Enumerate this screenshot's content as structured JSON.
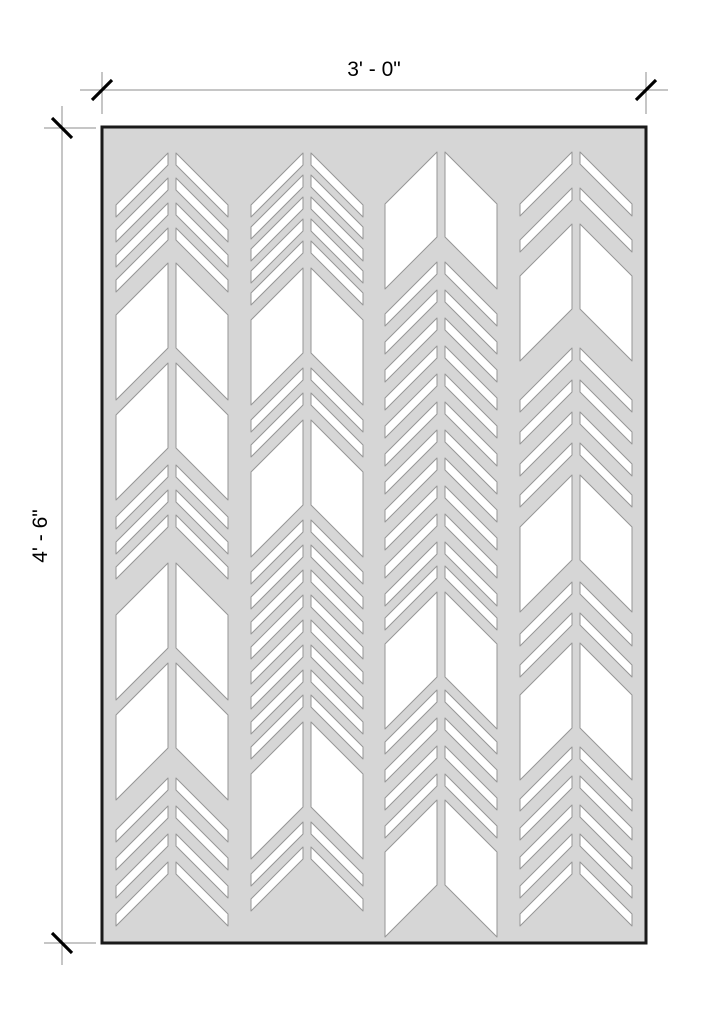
{
  "drawing": {
    "title": "Chevron pattern panel elevation",
    "dimensions": {
      "width": {
        "label": "3' - 0\""
      },
      "height": {
        "label": "4' - 6\""
      }
    }
  },
  "colors": {
    "background": "#ffffff",
    "panel_fill": "#d6d6d6",
    "panel_border": "#1a1a1a",
    "cutout_fill": "#ffffff",
    "cutout_stroke": "#969696",
    "dimension_line": "#8c8c8c",
    "tick": "#000000",
    "text": "#000000"
  },
  "panel": {
    "x": 102,
    "y": 127,
    "width": 544,
    "height": 816
  },
  "pattern": {
    "inner_offset": 4,
    "half_width": 56,
    "shear_drop": 52,
    "strip_thickness": 12,
    "leaf_thickness": 85,
    "columns": [
      {
        "spine": 172,
        "items": [
          {
            "type": "strip",
            "y": 153
          },
          {
            "type": "strip",
            "y": 178
          },
          {
            "type": "strip",
            "y": 203
          },
          {
            "type": "strip",
            "y": 228
          },
          {
            "type": "leaf",
            "y": 263
          },
          {
            "type": "leaf",
            "y": 363
          },
          {
            "type": "strip",
            "y": 465
          },
          {
            "type": "strip",
            "y": 490
          },
          {
            "type": "strip",
            "y": 515
          },
          {
            "type": "leaf",
            "y": 563
          },
          {
            "type": "leaf",
            "y": 663
          },
          {
            "type": "strip",
            "y": 778
          },
          {
            "type": "strip",
            "y": 806
          },
          {
            "type": "strip",
            "y": 834
          },
          {
            "type": "strip",
            "y": 862
          }
        ]
      },
      {
        "spine": 307,
        "items": [
          {
            "type": "strip",
            "y": 153
          },
          {
            "type": "strip",
            "y": 175
          },
          {
            "type": "strip",
            "y": 197
          },
          {
            "type": "strip",
            "y": 219
          },
          {
            "type": "strip",
            "y": 241
          },
          {
            "type": "leaf",
            "y": 268
          },
          {
            "type": "strip",
            "y": 368
          },
          {
            "type": "strip",
            "y": 393
          },
          {
            "type": "leaf",
            "y": 420
          },
          {
            "type": "strip",
            "y": 520
          },
          {
            "type": "strip",
            "y": 545
          },
          {
            "type": "strip",
            "y": 570
          },
          {
            "type": "strip",
            "y": 595
          },
          {
            "type": "strip",
            "y": 620
          },
          {
            "type": "strip",
            "y": 645
          },
          {
            "type": "strip",
            "y": 670
          },
          {
            "type": "strip",
            "y": 695
          },
          {
            "type": "leaf",
            "y": 722
          },
          {
            "type": "strip",
            "y": 822
          },
          {
            "type": "strip",
            "y": 847
          }
        ]
      },
      {
        "spine": 441,
        "items": [
          {
            "type": "leaf",
            "y": 152
          },
          {
            "type": "strip",
            "y": 262
          },
          {
            "type": "strip",
            "y": 290
          },
          {
            "type": "strip",
            "y": 318
          },
          {
            "type": "strip",
            "y": 346
          },
          {
            "type": "strip",
            "y": 374
          },
          {
            "type": "strip",
            "y": 402
          },
          {
            "type": "strip",
            "y": 430
          },
          {
            "type": "strip",
            "y": 458
          },
          {
            "type": "strip",
            "y": 486
          },
          {
            "type": "strip",
            "y": 514
          },
          {
            "type": "strip",
            "y": 542
          },
          {
            "type": "strip",
            "y": 566
          },
          {
            "type": "leaf",
            "y": 592
          },
          {
            "type": "strip",
            "y": 690
          },
          {
            "type": "strip",
            "y": 718
          },
          {
            "type": "strip",
            "y": 746
          },
          {
            "type": "strip",
            "y": 774
          },
          {
            "type": "leaf",
            "y": 800
          }
        ]
      },
      {
        "spine": 576,
        "items": [
          {
            "type": "strip",
            "y": 152
          },
          {
            "type": "strip",
            "y": 188
          },
          {
            "type": "leaf",
            "y": 224
          },
          {
            "type": "strip",
            "y": 348
          },
          {
            "type": "strip",
            "y": 380
          },
          {
            "type": "strip",
            "y": 412
          },
          {
            "type": "strip",
            "y": 443
          },
          {
            "type": "leaf",
            "y": 475
          },
          {
            "type": "strip",
            "y": 582
          },
          {
            "type": "strip",
            "y": 613
          },
          {
            "type": "leaf",
            "y": 643
          },
          {
            "type": "strip",
            "y": 747
          },
          {
            "type": "strip",
            "y": 776
          },
          {
            "type": "strip",
            "y": 805
          },
          {
            "type": "strip",
            "y": 834
          },
          {
            "type": "strip",
            "y": 862
          }
        ]
      }
    ]
  }
}
